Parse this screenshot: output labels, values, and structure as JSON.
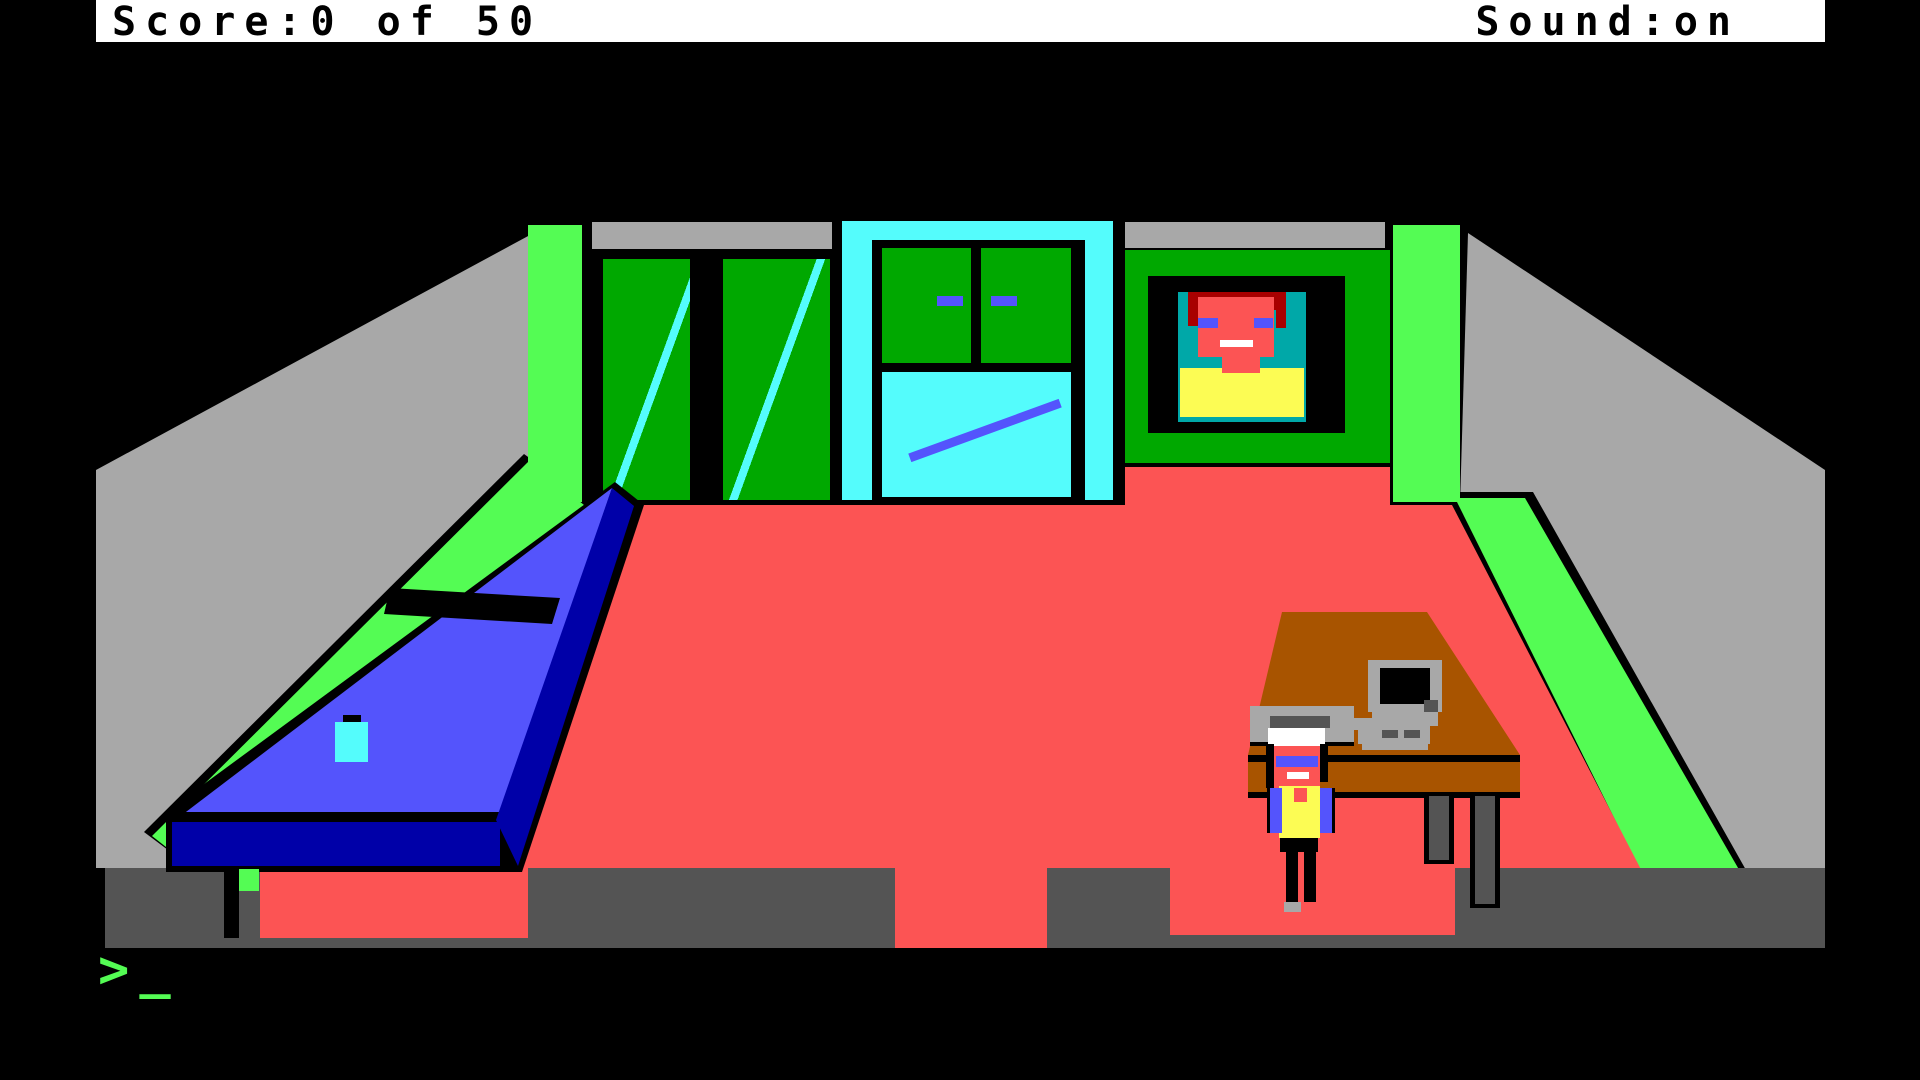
{
  "title": "AGI adventure game — bedroom scene",
  "status_bar": {
    "score_label": "Score:0 of 50",
    "sound_label": "Sound:on"
  },
  "prompt": {
    "symbol": ">",
    "cursor": "_"
  },
  "palette": {
    "black": "#000000",
    "white": "#FFFFFF",
    "gray": "#A8A8A8",
    "darkgray": "#545454",
    "green": "#00A800",
    "lightgreen": "#54FC54",
    "cyan": "#54FCFC",
    "teal": "#00A8A8",
    "blue": "#5454FC",
    "darkblue": "#0000A8",
    "red": "#FC5454",
    "darkred": "#A80000",
    "brown": "#A85400",
    "yellow": "#FCFC54"
  },
  "scene": {
    "room": "bedroom",
    "objects": [
      "window",
      "door",
      "portrait",
      "bed",
      "pillow",
      "desk",
      "computer",
      "printer",
      "character"
    ]
  }
}
